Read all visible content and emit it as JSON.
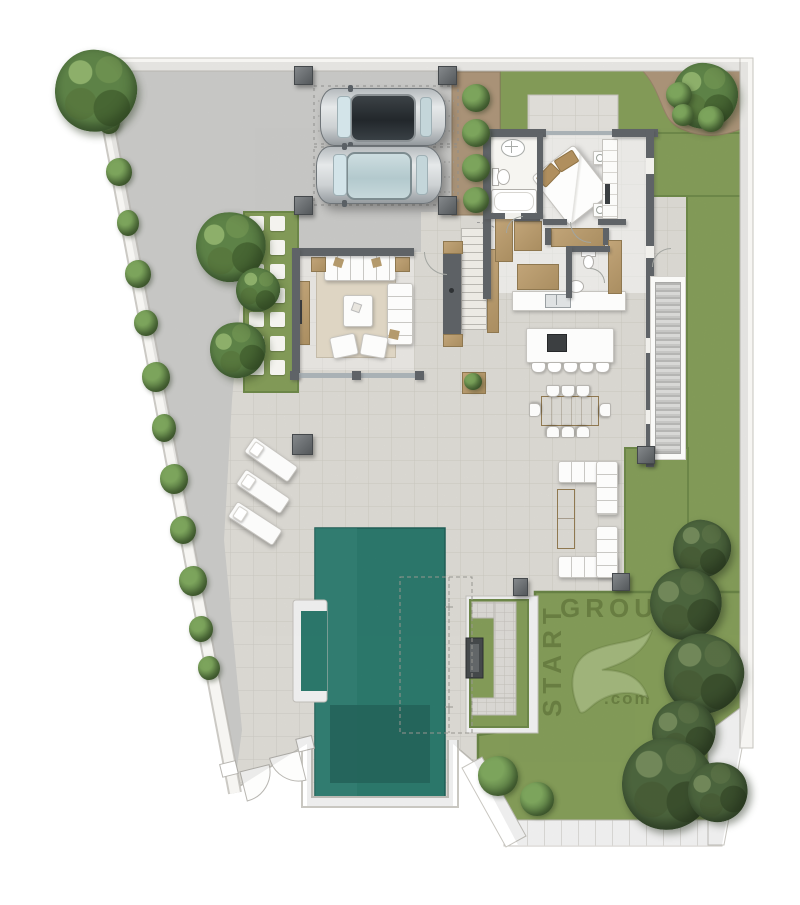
{
  "watermark": {
    "vertical_text": "START",
    "horizontal_text": "GROUP",
    "suffix_text": ".com"
  },
  "palette": {
    "page_bg": "#ffffff",
    "patio": "#eae8e1",
    "driveway": "#d5d5d3",
    "lawn": "#8ca65e",
    "lawn_edge": "#75914e",
    "mulch": "#b69e81",
    "pool_water": "#2f8073",
    "pool_deep": "#276a60",
    "wall": "#5f6367",
    "wood": "#b49a6c",
    "white_furniture": "#fcfcfb",
    "tree_green": "#5d8247",
    "watermark_green": "rgba(84,102,48,0.55)"
  },
  "scene_counts": {
    "cars": 2,
    "sun_loungers": 3,
    "dining_chairs": 8,
    "kitchen_island_stools": 5,
    "planter_bushes": 4,
    "outdoor_lounge_sofas": 2
  }
}
